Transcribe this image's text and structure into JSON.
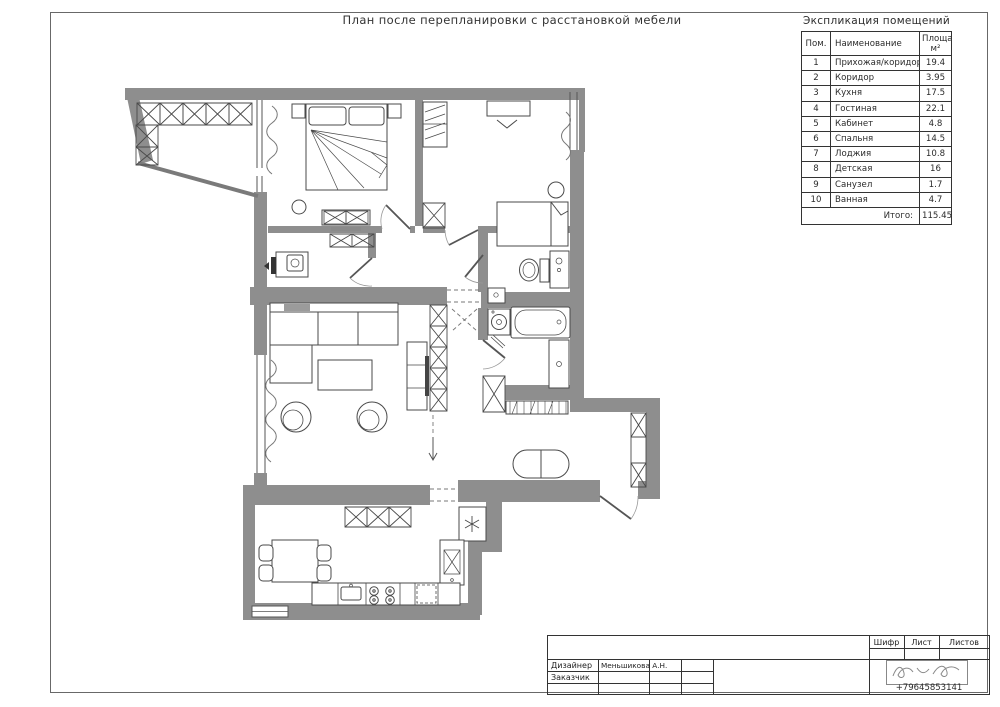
{
  "sheet": {
    "title": "План после перепланировки с расстановкой мебели"
  },
  "colors": {
    "wall": "#8e8e8e"
  },
  "explication": {
    "title": "Экспликация помещений",
    "col_num": "Пом.",
    "col_name": "Наименование",
    "col_area": "Площадь",
    "col_area_unit": "м²",
    "rows": [
      {
        "num": "1",
        "name": "Прихожая/коридор",
        "area": "19.4"
      },
      {
        "num": "2",
        "name": "Коридор",
        "area": "3.95"
      },
      {
        "num": "3",
        "name": "Кухня",
        "area": "17.5"
      },
      {
        "num": "4",
        "name": "Гостиная",
        "area": "22.1"
      },
      {
        "num": "5",
        "name": "Кабинет",
        "area": "4.8"
      },
      {
        "num": "6",
        "name": "Спальня",
        "area": "14.5"
      },
      {
        "num": "7",
        "name": "Лоджия",
        "area": "10.8"
      },
      {
        "num": "8",
        "name": "Детская",
        "area": "16"
      },
      {
        "num": "9",
        "name": "Санузел",
        "area": "1.7"
      },
      {
        "num": "10",
        "name": "Ванная",
        "area": "4.7"
      }
    ],
    "total_label": "Итого:",
    "total_value": "115.45"
  },
  "titleblock": {
    "cipher_label": "Шифр",
    "sheet_label": "Лист",
    "sheets_label": "Листов",
    "designer_label": "Дизайнер",
    "designer_name": "Меньшикова А.Н.",
    "client_label": "Заказчик",
    "phone": "+79645853141"
  }
}
